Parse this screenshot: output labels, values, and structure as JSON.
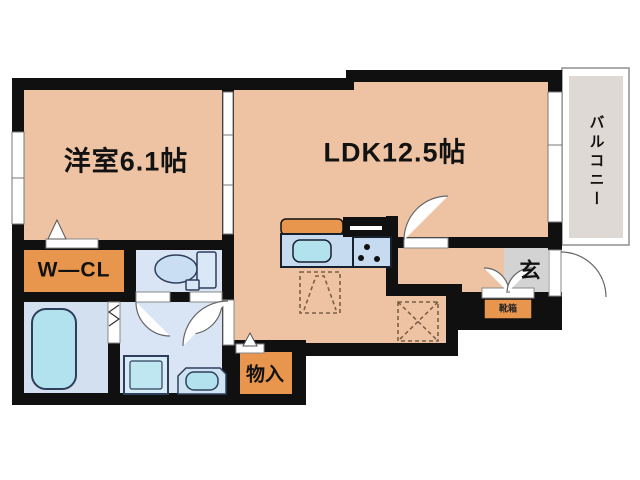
{
  "floorplan": {
    "type_note": "Japanese apartment floor plan (1LDK)",
    "rooms": {
      "western_room": {
        "label": "洋室6.1帖"
      },
      "ldk": {
        "label": "LDK12.5帖"
      },
      "balcony": {
        "label": "バルコニー"
      },
      "walk_in_closet": {
        "label": "W―CL"
      },
      "entrance": {
        "label": "玄"
      },
      "storage": {
        "label": "物入"
      },
      "shoe_cabinet": {
        "label": "靴箱"
      }
    },
    "colors": {
      "wall": "#101010",
      "room_salmon": "#eec3a3",
      "accent_orange": "#e8964e",
      "wet_room_blue": "#d9e5f4",
      "fixture_cyan": "#b2e2ee",
      "fixture_stroke": "#2e3f5c",
      "entrance_gray": "#d3d3d3",
      "balcony_fill": "#ded9d5",
      "balcony_border": "#909090",
      "dashed_marker": "#7c5f46"
    },
    "fixtures": [
      "bathtub",
      "toilet",
      "washing-machine",
      "vanity-sink",
      "kitchen-counter",
      "kitchen-sink",
      "stove"
    ]
  }
}
